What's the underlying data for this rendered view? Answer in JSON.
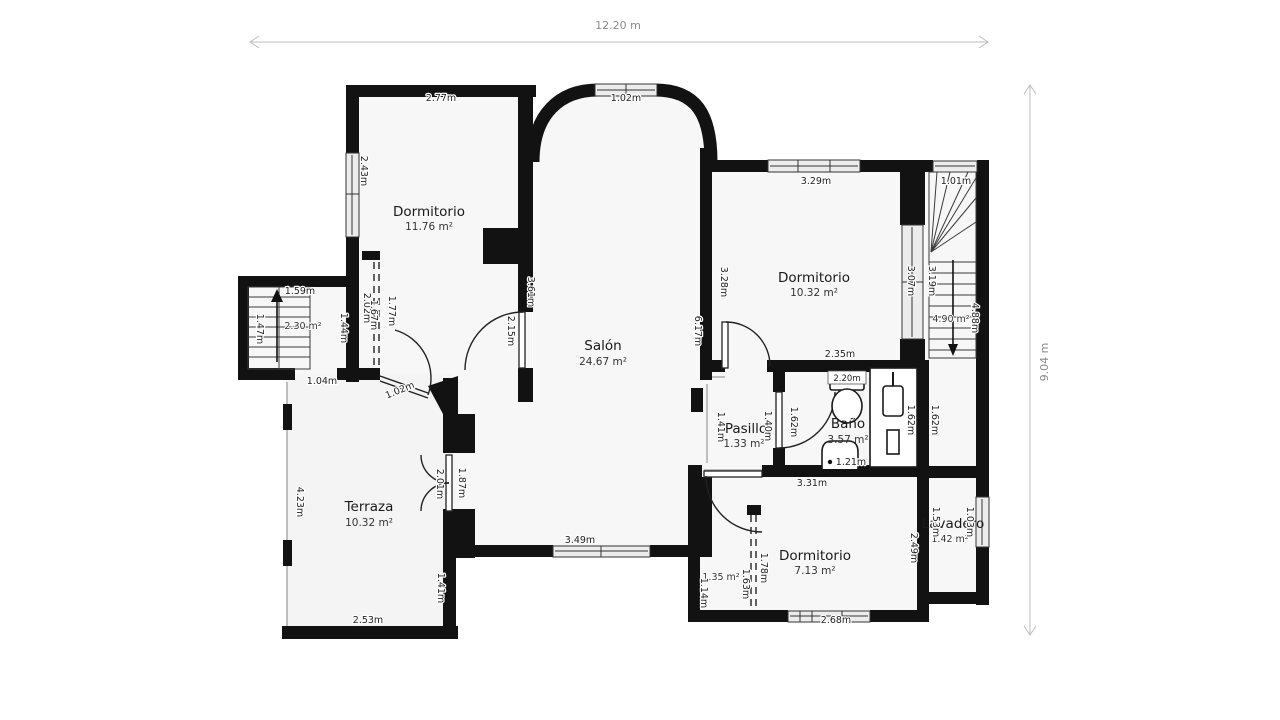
{
  "floor_plan": {
    "overall": {
      "width": "12.20 m",
      "height": "9.04 m"
    },
    "rooms": {
      "dormitorio_top_left": {
        "name": "Dormitorio",
        "area": "11.76 m²"
      },
      "salon": {
        "name": "Salón",
        "area": "24.67 m²"
      },
      "dormitorio_top_right": {
        "name": "Dormitorio",
        "area": "10.32 m²"
      },
      "terraza": {
        "name": "Terraza",
        "area": "10.32 m²"
      },
      "pasillo": {
        "name": "Pasillo",
        "area": "1.33 m²"
      },
      "bano": {
        "name": "Baño",
        "area": "3.57 m²"
      },
      "dormitorio_bottom": {
        "name": "Dormitorio",
        "area": "7.13 m²"
      },
      "lavadero": {
        "name": "Lavadero",
        "area": "1.42 m²"
      },
      "stairwell_left": {
        "area": "2.30 m²"
      },
      "stairwell_right": {
        "area": "4.90 m²"
      },
      "closet_bottom": {
        "area": "1.35 m²"
      }
    },
    "dims": {
      "tl_top": "2.77m",
      "tl_window": "2.43m",
      "tl_wall_salon": "3.61m",
      "tl_door": "2.15m",
      "tl_closet_a": "2.02m",
      "tl_closet_b": "1.67m",
      "tl_closet_dash": "1.77m",
      "salon_arch_window": "1.02m",
      "salon_right_wall": "6.17m",
      "salon_bottom_window": "3.49m",
      "tr_top_window": "3.29m",
      "tr_left_wall": "3.28m",
      "tr_right_window": "3.07m",
      "tr_bottom": "2.35m",
      "stairs_right_top": "1.01m",
      "stairs_right_run": "3.19m",
      "stairs_right_height": "4.88m",
      "stairs_left_top": "1.59m",
      "stairs_left_side": "1.47m",
      "stairs_landing": "1.44m",
      "stairs_left_exit": "1.04m",
      "terraza_door": "1.02m",
      "terraza_left": "4.23m",
      "terraza_bottom": "2.53m",
      "terraza_right": "1.41m",
      "terraza_french_left": "2.01m",
      "terraza_french_right": "1.87m",
      "pasillo_left": "1.41m",
      "pasillo_right": "1.40m",
      "bano_top": "2.20m",
      "bano_door": "1.62m",
      "bano_vanity": "1.62m",
      "bano_side": "1.62m",
      "bano_shower": "1.21m",
      "br_top": "3.31m",
      "br_bottom_window": "2.68m",
      "br_right": "2.49m",
      "closet_left": "1.14m",
      "closet_inner": "1.63m",
      "closet_dash": "1.78m",
      "lav_left": "1.53m",
      "lav_right": "1.03m"
    },
    "colors": {
      "wall": "#121212",
      "room_fill": "#f7f7f7",
      "window_fill": "#ececec",
      "dim_text": "#222222",
      "outer_dim_text": "#8a8a8a"
    }
  }
}
